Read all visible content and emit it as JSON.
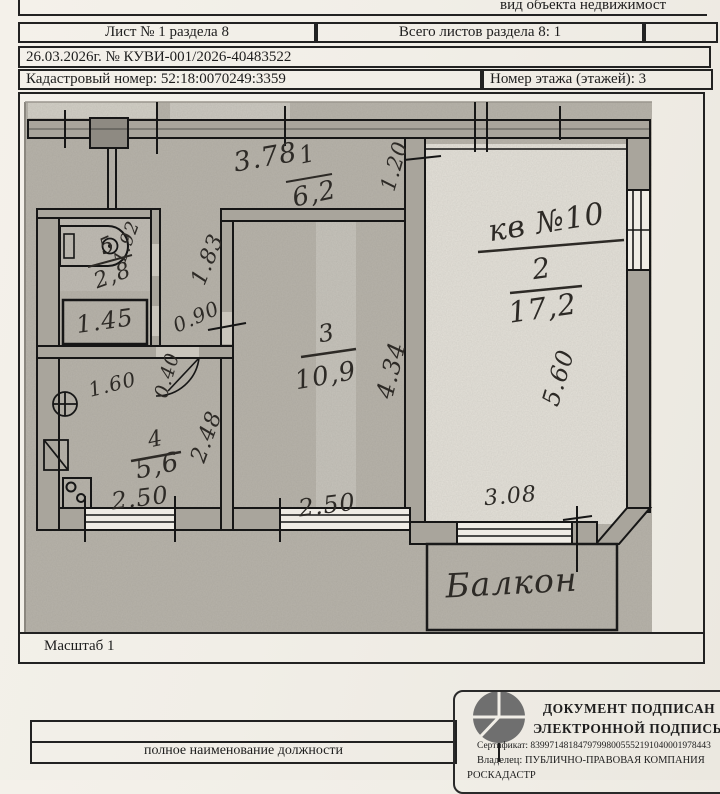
{
  "header": {
    "object_kind_label": "вид объекта недвижимост",
    "sheet_label": "Лист № 1 раздела 8",
    "total_sheets_label": "Всего листов раздела 8: 1",
    "doc_date_number": "26.03.2026г. № КУВИ-001/2026-40483522",
    "cadastral_number": "Кадастровый номер: 52:18:0070249:3359",
    "floor_number": "Номер этажа (этажей): 3"
  },
  "plan": {
    "apartment_label": "кв №10",
    "balcony_label": "Балкон",
    "scale_label": "Масштаб 1",
    "rooms": [
      {
        "num": "1",
        "area": "6,2"
      },
      {
        "num": "2",
        "area": "17,2"
      },
      {
        "num": "3",
        "area": "10,9"
      },
      {
        "num": "4",
        "area": "5,6"
      },
      {
        "num": "5",
        "area": "2,8"
      }
    ],
    "dims": {
      "hall_width": "3.78",
      "hall_opening": "1.20",
      "corridor_len": "1.83",
      "corridor_door": "0.90",
      "wall_niche": "0.40",
      "bath_width": "1.92",
      "wc_width": "1.45",
      "kitchen_niche": "1.60",
      "kitchen_depth": "2.48",
      "room3_depth": "4.34",
      "room2_depth": "5.60",
      "kitchen_window": "2.50",
      "room3_window": "2.50",
      "room2_window": "3.08"
    }
  },
  "footer": {
    "position_caption": "полное наименование должности",
    "stamp": {
      "title_line1": "ДОКУМЕНТ ПОДПИСАН",
      "title_line2": "ЭЛЕКТРОННОЙ ПОДПИСЬЮ",
      "certificate": "Сертификат: 83997148184797998005552191040001978443",
      "owner_line1": "Владелец: ПУБЛИЧНО-ПРАВОВАЯ КОМПАНИЯ",
      "owner_line2": "РОСКАДАСТР"
    }
  }
}
